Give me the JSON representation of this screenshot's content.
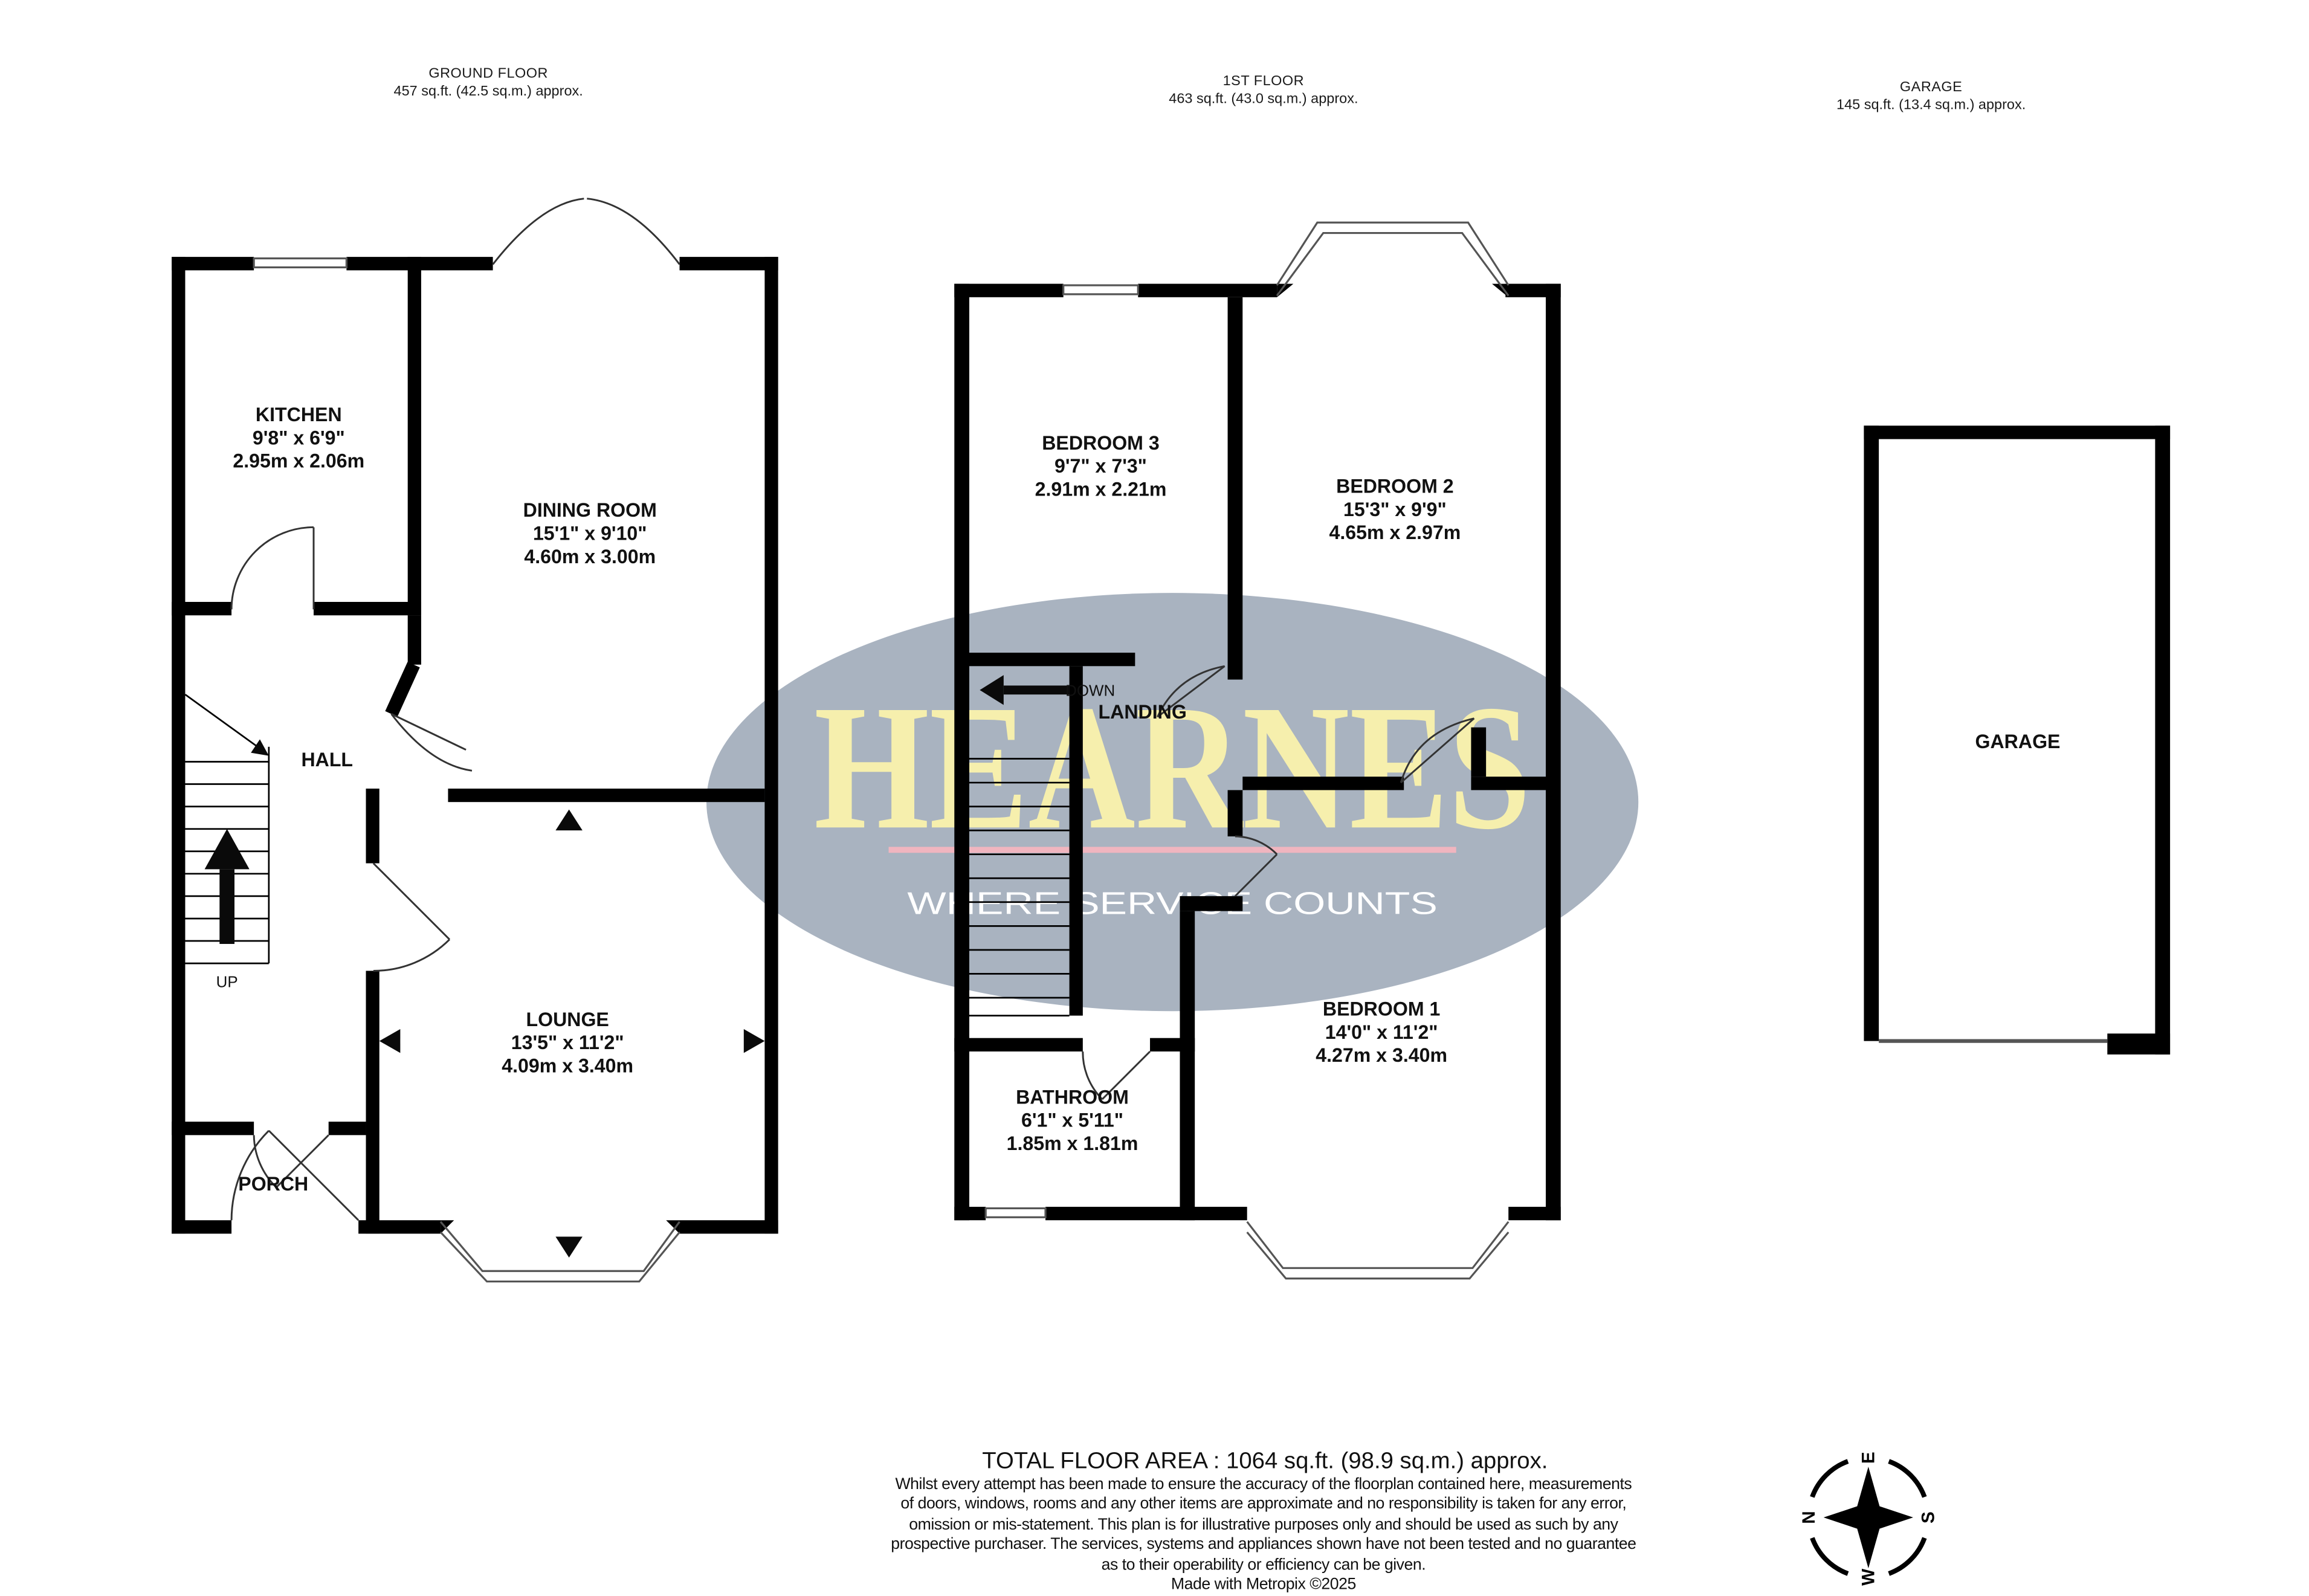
{
  "headers": {
    "ground_floor": {
      "title": "GROUND FLOOR",
      "area": "457 sq.ft. (42.5 sq.m.) approx."
    },
    "first_floor": {
      "title": "1ST FLOOR",
      "area": "463 sq.ft. (43.0 sq.m.) approx."
    },
    "garage": {
      "title": "GARAGE",
      "area": "145 sq.ft. (13.4 sq.m.) approx."
    }
  },
  "ground_floor": {
    "rooms": {
      "kitchen": {
        "name": "KITCHEN",
        "imperial": "9'8\" x 6'9\"",
        "metric": "2.95m x 2.06m"
      },
      "dining_room": {
        "name": "DINING ROOM",
        "imperial": "15'1\" x 9'10\"",
        "metric": "4.60m x 3.00m"
      },
      "hall": {
        "name": "HALL"
      },
      "lounge": {
        "name": "LOUNGE",
        "imperial": "13'5\" x 11'2\"",
        "metric": "4.09m x 3.40m"
      },
      "porch": {
        "name": "PORCH"
      }
    },
    "stairs_label": "UP"
  },
  "first_floor": {
    "rooms": {
      "bedroom_3": {
        "name": "BEDROOM 3",
        "imperial": "9'7\" x 7'3\"",
        "metric": "2.91m x 2.21m"
      },
      "bedroom_2": {
        "name": "BEDROOM 2",
        "imperial": "15'3\" x 9'9\"",
        "metric": "4.65m x 2.97m"
      },
      "landing": {
        "name": "LANDING"
      },
      "bedroom_1": {
        "name": "BEDROOM 1",
        "imperial": "14'0\" x 11'2\"",
        "metric": "4.27m x 3.40m"
      },
      "bathroom": {
        "name": "BATHROOM",
        "imperial": "6'1\" x 5'11\"",
        "metric": "1.85m x 1.81m"
      }
    },
    "stairs_label": "DOWN"
  },
  "garage_plan": {
    "rooms": {
      "garage": {
        "name": "GARAGE"
      }
    }
  },
  "watermark": {
    "brand": "HEARNES",
    "tagline": "WHERE SERVICE COUNTS",
    "colors": {
      "ellipse": "#a9b3c0",
      "brand": "#f6efad",
      "divider": "#f0b5bf",
      "tagline": "#ffffff"
    }
  },
  "compass": {
    "north": "N",
    "east": "E",
    "south": "S",
    "west": "W"
  },
  "footer": {
    "total_area": "TOTAL FLOOR AREA : 1064 sq.ft. (98.9 sq.m.) approx.",
    "disclaimer": [
      "Whilst every attempt has been made to ensure the accuracy of the floorplan contained here, measurements",
      "of doors, windows, rooms and any other items are approximate and no responsibility is taken for any error,",
      "omission or mis-statement. This plan is for illustrative purposes only and should be used as such by any",
      "prospective purchaser. The services, systems and appliances shown have not been tested and no guarantee",
      "as to their operability or efficiency can be given.",
      "Made with Metropix ©2025"
    ]
  }
}
